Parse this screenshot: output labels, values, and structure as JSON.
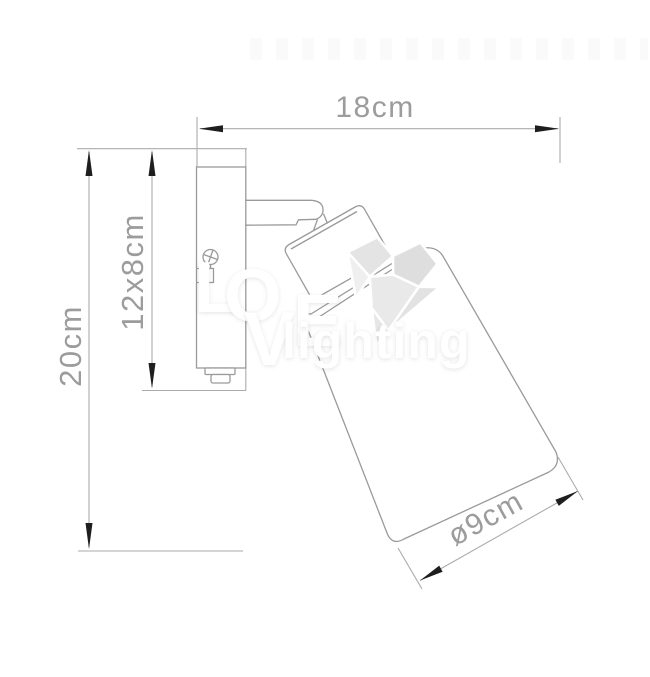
{
  "dimensions": {
    "width": "18cm",
    "height": "20cm",
    "backplate": "12x8cm",
    "shade_diameter": "ø9cm"
  },
  "watermark": {
    "letters": [
      "L",
      "O",
      "V",
      "E"
    ],
    "word": "lighting"
  },
  "colors": {
    "line_fixture": "#9a9a9a",
    "line_dimension": "#ababab",
    "arrow": "#1e1e1e",
    "dim_text": "#9c9c9c",
    "watermark_text": "#ffffff"
  }
}
